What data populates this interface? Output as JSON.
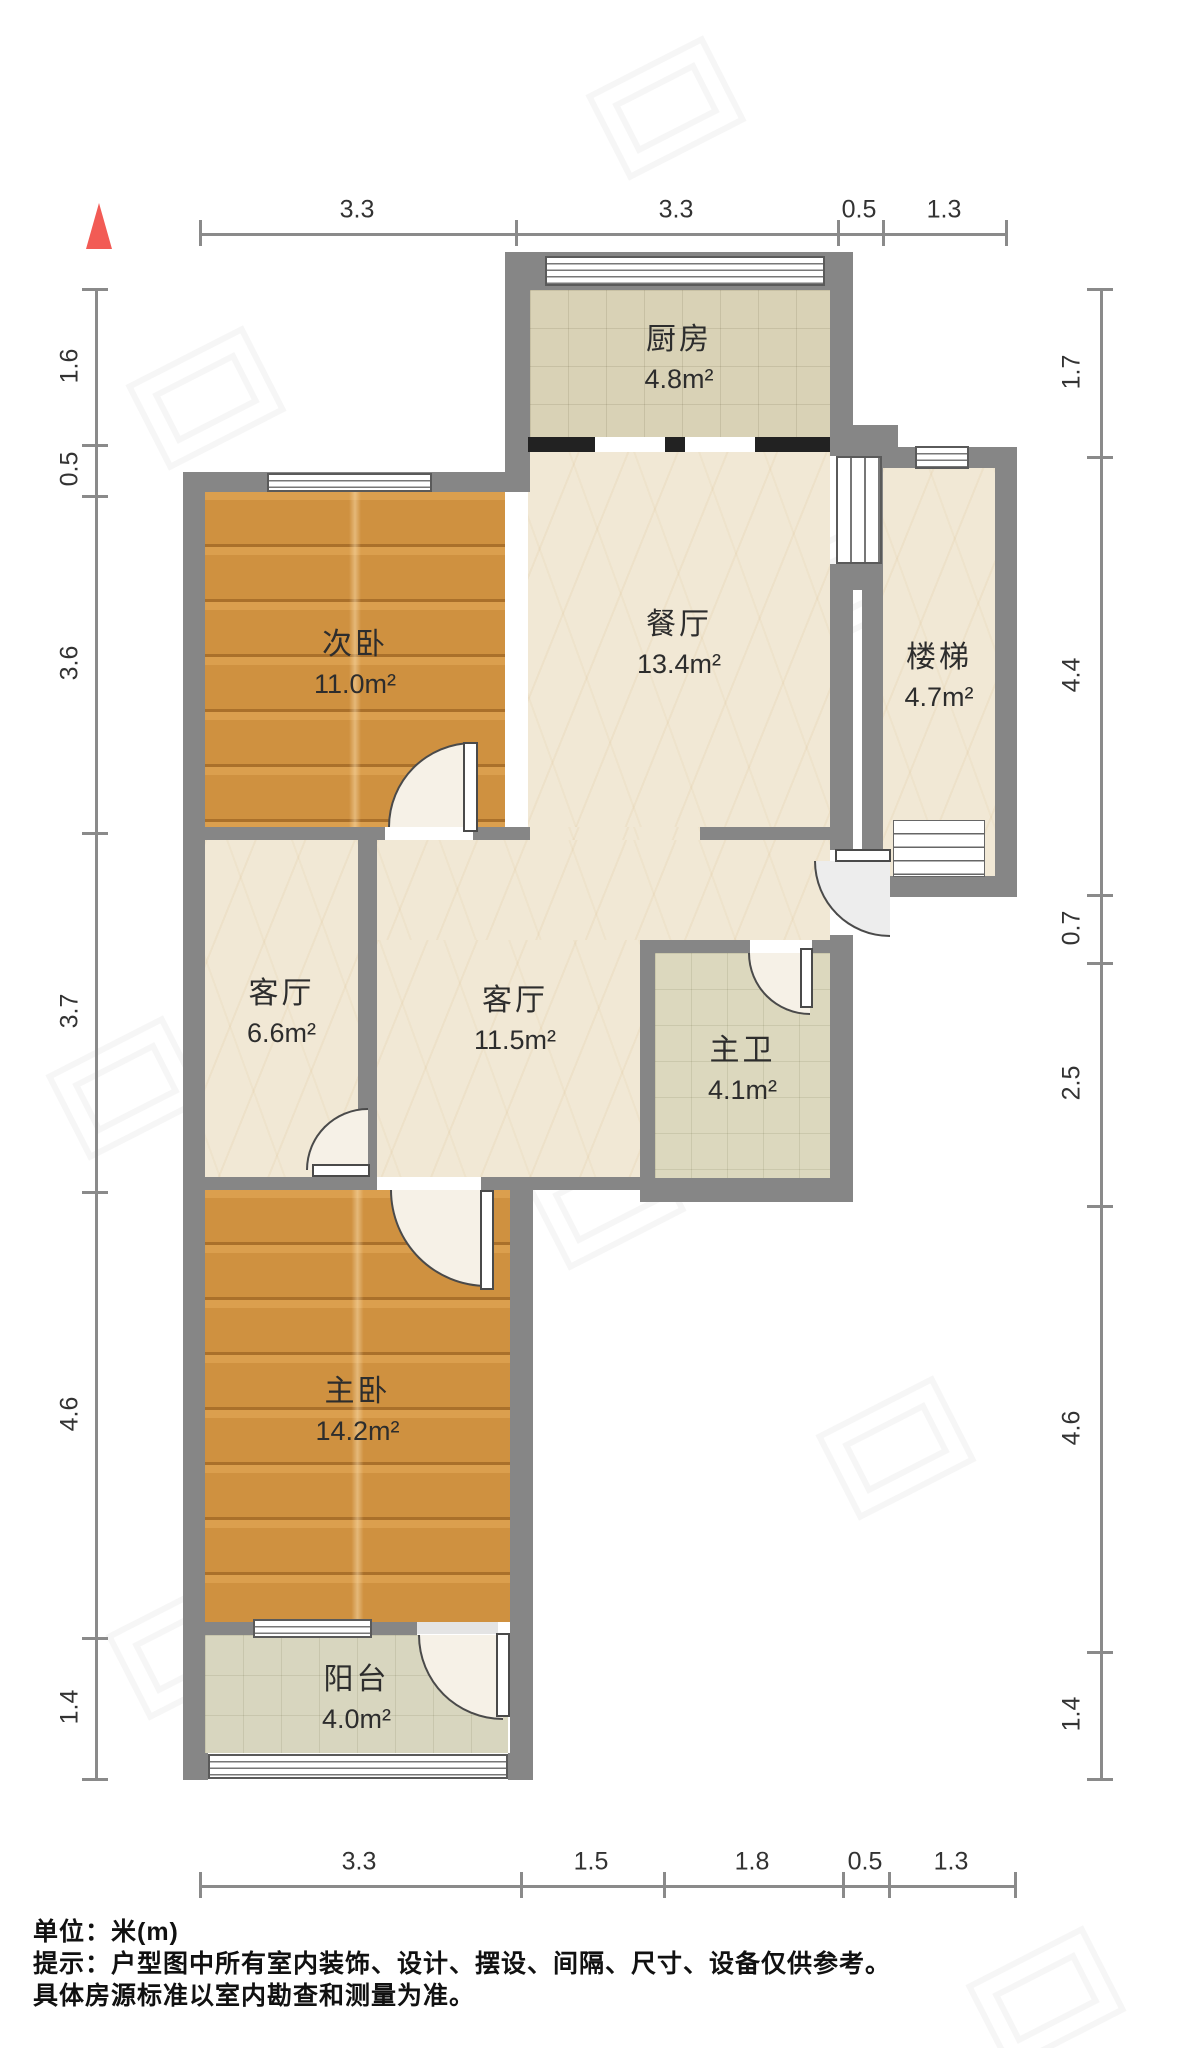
{
  "compass": {
    "description": "north-triangle"
  },
  "rooms": {
    "kitchen": {
      "name": "厨房",
      "area": "4.8m²"
    },
    "dining": {
      "name": "餐厅",
      "area": "13.4m²"
    },
    "stairs": {
      "name": "楼梯",
      "area": "4.7m²"
    },
    "bedroom2": {
      "name": "次卧",
      "area": "11.0m²"
    },
    "living_small": {
      "name": "客厅",
      "area": "6.6m²"
    },
    "living_large": {
      "name": "客厅",
      "area": "11.5m²"
    },
    "bathroom": {
      "name": "主卫",
      "area": "4.1m²"
    },
    "bedroom1": {
      "name": "主卧",
      "area": "14.2m²"
    },
    "balcony": {
      "name": "阳台",
      "area": "4.0m²"
    }
  },
  "dims": {
    "top": [
      {
        "label": "3.3"
      },
      {
        "label": "3.3"
      },
      {
        "label": "0.5"
      },
      {
        "label": "1.3"
      }
    ],
    "bottom": [
      {
        "label": "3.3"
      },
      {
        "label": "1.5"
      },
      {
        "label": "1.8"
      },
      {
        "label": "0.5"
      },
      {
        "label": "1.3"
      }
    ],
    "left": [
      {
        "label": "1.6"
      },
      {
        "label": "0.5"
      },
      {
        "label": "3.6"
      },
      {
        "label": "3.7"
      },
      {
        "label": "4.6"
      },
      {
        "label": "1.4"
      }
    ],
    "right": [
      {
        "label": "1.7"
      },
      {
        "label": "4.4"
      },
      {
        "label": "0.7"
      },
      {
        "label": "2.5"
      },
      {
        "label": "4.6"
      },
      {
        "label": "1.4"
      }
    ]
  },
  "footer": {
    "unit": "单位：米(m)",
    "tip": "提示：户型图中所有室内装饰、设计、摆设、间隔、尺寸、设备仅供参考。",
    "tip2": "具体房源标准以室内勘查和测量为准。"
  },
  "colors": {
    "wall": "#868686",
    "wood_floor": "#cf9140",
    "marble_floor": "#f1e8d5",
    "tile_floor": "#d9d2b6",
    "compass_red": "#f25b55"
  }
}
